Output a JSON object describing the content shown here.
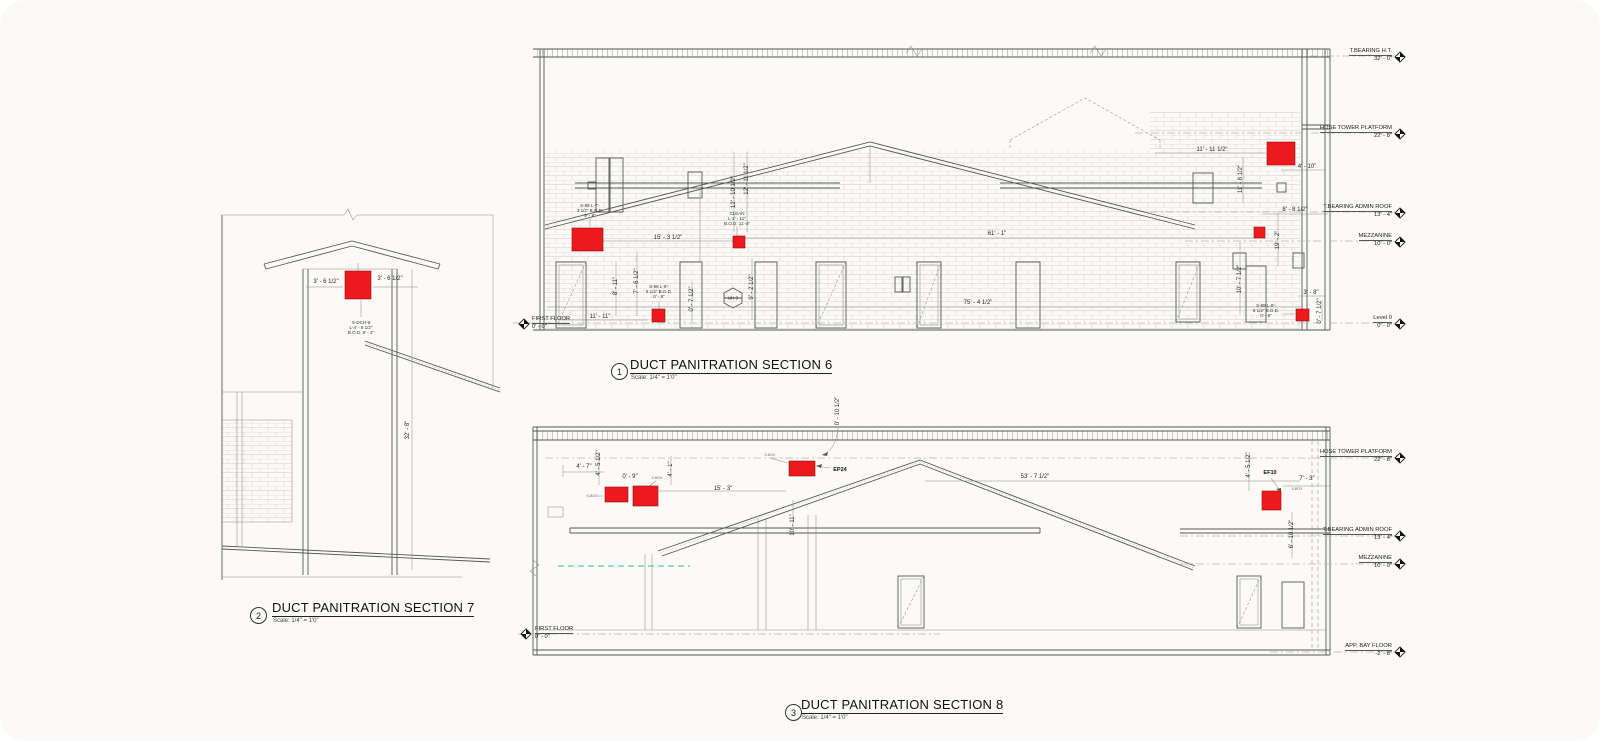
{
  "palette": {
    "red": "#ed1a1d",
    "line": "#565656",
    "background": "#fbfaf7"
  },
  "titles": [
    {
      "num": "1",
      "title": "DUCT PANITRATION SECTION 6",
      "scale": "Scale: 1/4\" = 1'0\""
    },
    {
      "num": "2",
      "title": "DUCT PANITRATION SECTION 7",
      "scale": "Scale: 1/4\" = 1'0\""
    },
    {
      "num": "3",
      "title": "DUCT PANITRATION SECTION 8",
      "scale": "Scale: 1/4\" = 1'0\""
    }
  ],
  "s6": {
    "markers_right": [
      {
        "name": "T.BEARING H.T.",
        "elev": "32' - 0\""
      },
      {
        "name": "HOSE TOWER PLATFORM",
        "elev": "22' - 8\""
      },
      {
        "name": "T.BEARING ADMIN ROOF",
        "elev": "13' - 4\""
      },
      {
        "name": "MEZZANINE",
        "elev": "10' - 0\""
      },
      {
        "name": "Level 0",
        "elev": "0' - 0\""
      }
    ],
    "marker_left": {
      "name": "FIRST FLOOR",
      "elev": "0' - 0\""
    },
    "dims": [
      "15' - 3 1/2\"",
      "61' - 1\"",
      "75' - 4 1/2\"",
      "11' - 11\"",
      "8' - 11\"",
      "7' - 6 1/2\"",
      "0' - 7 1/2\"",
      "9' - 2 1/2\"",
      "12' - 10 1/2\"",
      "12' - 11 1/2\"",
      "11' - 11 1/2\"",
      "4' - 10\"",
      "11' - 8 1/2\"",
      "8' - 8 1/2\"",
      "19' - 2\"",
      "10' - 7 1/2\"",
      "3' - 8\"",
      "0' - 7 1/2\""
    ],
    "notes": [
      [
        "S-88 L-7'-",
        "3 1/2\" B.O.D.",
        "9' - 8\""
      ],
      [
        "S-88 L-9'-",
        "9 1/2\" B.O.D.",
        "0' - 8\""
      ],
      [
        "CLEAN",
        "L-2' - 11\"",
        "B.O.D. 11'-4\""
      ],
      [
        "S-88 L-9'-",
        "9 1/2\" B.O.D.",
        "0' - 9\""
      ]
    ],
    "uh_tag": {
      "top": "UH",
      "bottom": "3"
    }
  },
  "s7": {
    "dims": [
      "3' - 6 1/2\"",
      "3' - 6 1/2\"",
      "32' - 8\""
    ],
    "note": [
      "S-DCH-9",
      "L-4' - 8 1/2\"",
      "B.O.D. 9' - 2\""
    ]
  },
  "s8": {
    "markers_right": [
      {
        "name": "HOSE TOWER PLATFORM",
        "elev": "22' - 8\""
      },
      {
        "name": "T.BEARING ADMIN ROOF",
        "elev": "13' - 4\""
      },
      {
        "name": "MEZZANINE",
        "elev": "10' - 0\""
      },
      {
        "name": "APP. BAY FLOOR",
        "elev": "-2' - 8\""
      }
    ],
    "marker_left": {
      "name": "FIRST FLOOR",
      "elev": "0' - 0\""
    },
    "dims": [
      "0' - 10 1/2\"",
      "4' - 7\"",
      "4' - 5 1/2\"",
      "0' - 9\"",
      "4' - 1\"",
      "15' - 3\"",
      "10' - 11\"",
      "53' - 7 1/2\"",
      "7' - 3\"",
      "4' - 5 1/2\"",
      "6' - 10 1/2\""
    ],
    "tags": [
      "EP24",
      "EF10"
    ],
    "small_tags": [
      "S-BOX",
      "S-BOX",
      "S-BOX",
      "S-BOX"
    ]
  }
}
